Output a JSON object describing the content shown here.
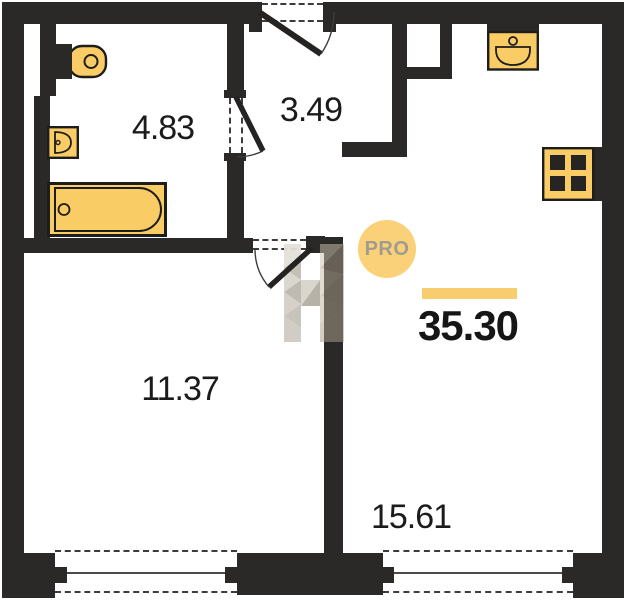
{
  "plan": {
    "badge": "PRO",
    "total_area": "35.30",
    "rooms": {
      "bathroom": "4.83",
      "hallway": "3.49",
      "living_room": "11.37",
      "kitchen_living": "15.61"
    },
    "colors": {
      "wall": "#2b2927",
      "fixture_fill": "#f9cc66",
      "fixture_outline": "#1d1d1b",
      "accent_bar": "#f8cd6e",
      "badge_background": "#fad178",
      "badge_text": "#a09c8f",
      "label_text": "#1b1b1b"
    }
  }
}
